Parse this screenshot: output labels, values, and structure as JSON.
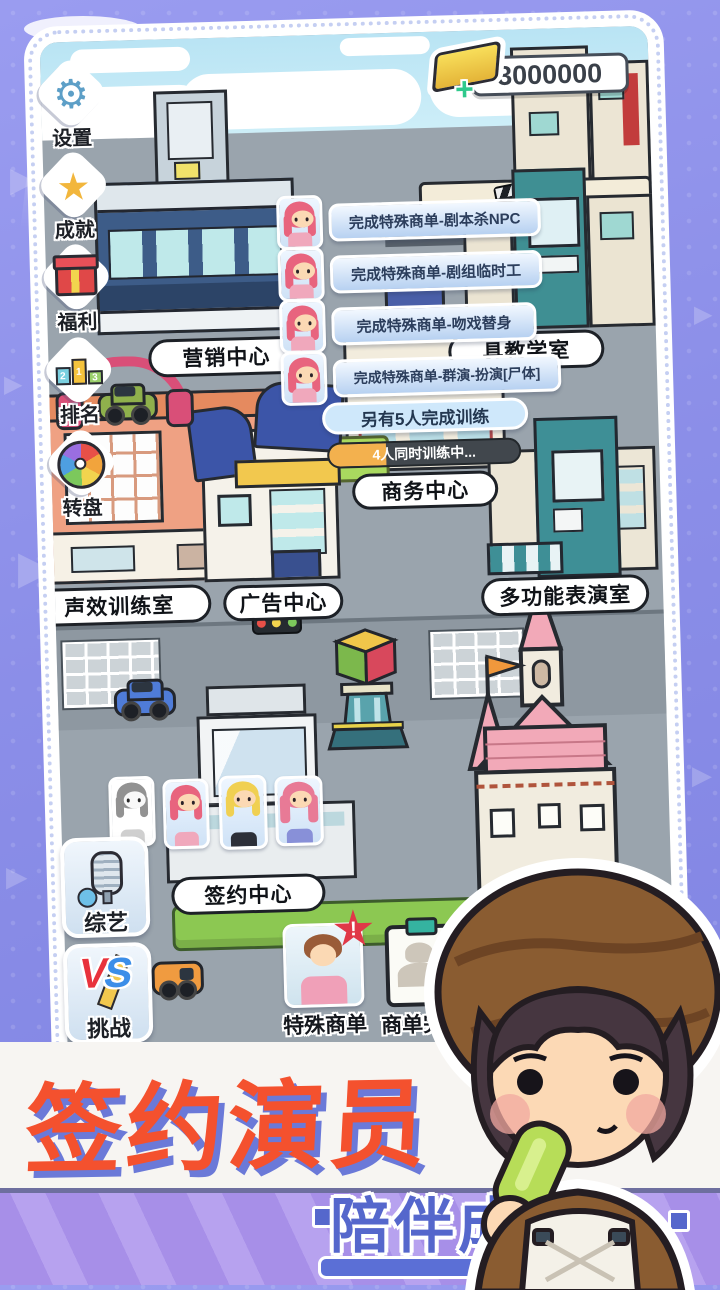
{
  "hud": {
    "currency": {
      "value": "3000000",
      "plus": "+"
    },
    "side_buttons": [
      {
        "id": "settings",
        "label": "设置"
      },
      {
        "id": "achievements",
        "label": "成就"
      },
      {
        "id": "welfare",
        "label": "福利"
      },
      {
        "id": "ranking",
        "label": "排名",
        "podium": [
          "2",
          "1",
          "3"
        ]
      },
      {
        "id": "wheel",
        "label": "转盘"
      }
    ],
    "corner_buttons": [
      {
        "id": "variety",
        "label": "综艺"
      },
      {
        "id": "challenge",
        "label": "挑战",
        "badge_v": "V",
        "badge_s": "S"
      }
    ],
    "order_buttons": [
      {
        "id": "special-orders",
        "label": "特殊商单",
        "badge": "!"
      },
      {
        "id": "orders-done",
        "label": "商单完成",
        "check": "✓"
      }
    ]
  },
  "tasks": [
    "完成特殊商单-剧本杀NPC",
    "完成特殊商单-剧组临时工",
    "完成特殊商单-吻戏替身",
    "完成特殊商单-群演-扮演[尸体]"
  ],
  "training": {
    "completed_banner": "另有5人完成训练",
    "in_progress": "4人同时训练中...",
    "progress_percent": 30
  },
  "buildings": {
    "marketing": "营销中心",
    "prop_teaching": "具教学室",
    "business": "商务中心",
    "sound_training": "声效训练室",
    "ad_center": "广告中心",
    "multi_room": "多功能表演室",
    "signing": "签约中心"
  },
  "footer": {
    "headline": "签约演员",
    "subline": "陪伴成长"
  },
  "colors": {
    "bg_purple": "#8b8ee8",
    "accent_orange": "#f4512e",
    "banner_blue": "#5567cc",
    "gold": "#f5cf3a"
  }
}
